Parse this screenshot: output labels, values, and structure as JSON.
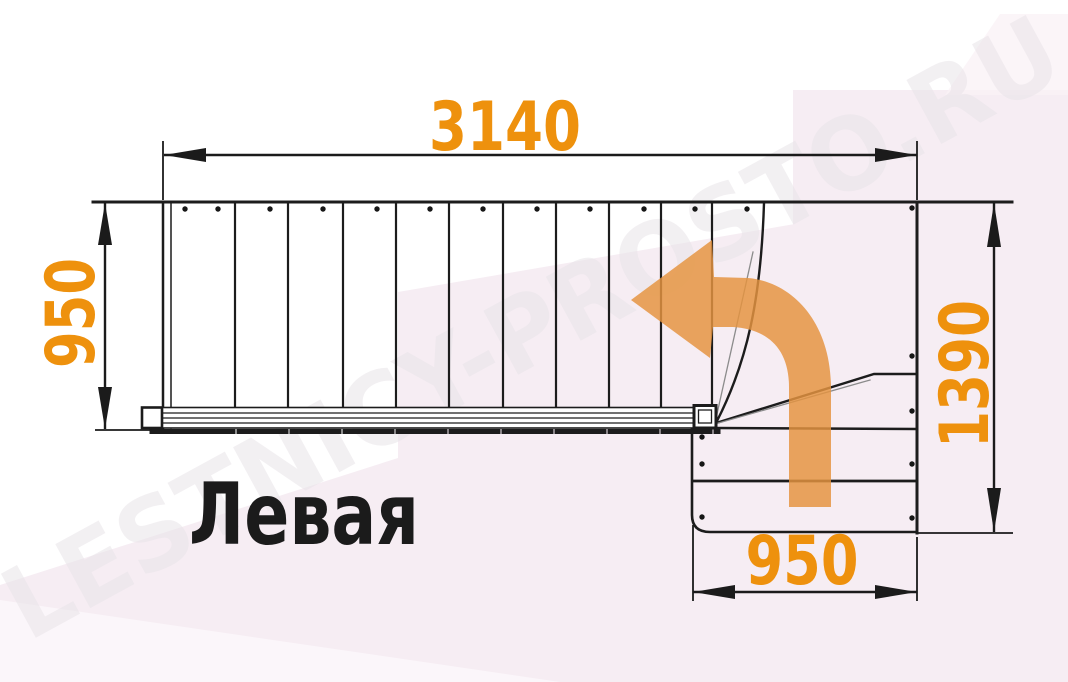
{
  "drawing": {
    "plan_label": "Левая",
    "watermark": "LESTNICY-PROSTO.RU",
    "dimensions": {
      "top_width": "3140",
      "left_depth": "950",
      "right_depth": "1390",
      "bottom_width": "950"
    },
    "colors": {
      "dimension_text": "#EE910D",
      "arrow": "#E59440",
      "line": "#1C1C1C",
      "background": "#FFFFFF",
      "background_tint": "#F6EDF3",
      "watermark": "#E9E4E9"
    },
    "arrow_icon": "curved-turn-left-arrow"
  }
}
